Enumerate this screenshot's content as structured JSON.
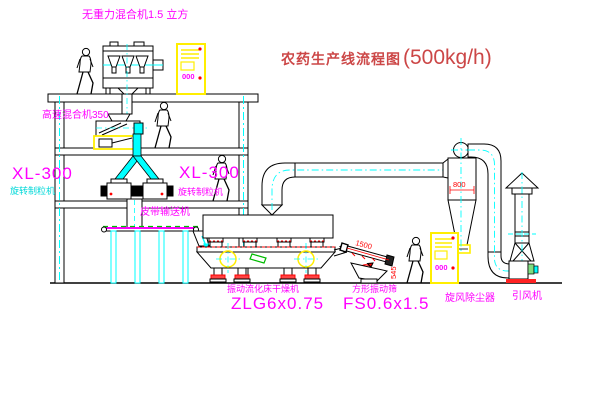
{
  "title": {
    "text": "农药生产线流程图",
    "capacity": "(500kg/h)"
  },
  "labels": {
    "gravity_mixer": "无重力混合机1.5 立方",
    "high_speed_mixer": "高速混合机350",
    "granulator_left_model": "XL-300",
    "granulator_left_name": "旋转制粒机",
    "granulator_right_model": "XL-300",
    "granulator_right_name": "旋转制粒机",
    "belt_conveyor": "皮带输送机",
    "dryer_name": "振动流化床干燥机",
    "dryer_model": "ZLG6x0.75",
    "screen_name": "方形振动筛",
    "screen_model": "FS0.6x1.5",
    "cyclone_name": "旋风除尘器",
    "fan_name": "引风机"
  },
  "dimensions": {
    "cyclone_width": "800",
    "screen_length": "1500",
    "screen_height": "545"
  },
  "control_cabinet": {
    "display": "000"
  },
  "colors": {
    "label_magenta": "#ff00ff",
    "pipe_cyan": "#00ffff",
    "title_red": "#cc4747",
    "dimension_red": "#ff0000",
    "cabinet_yellow": "#ffee00",
    "detail_green": "#00bb00"
  }
}
